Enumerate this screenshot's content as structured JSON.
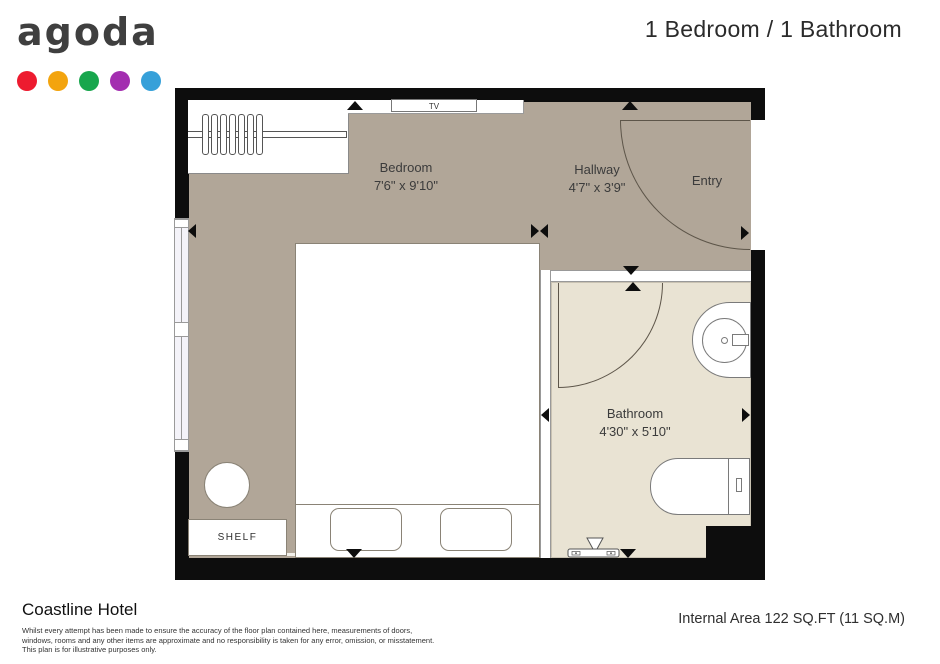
{
  "logo": {
    "text": "agoda",
    "dot_colors": [
      "#ed1b2f",
      "#f3a40e",
      "#18a64d",
      "#a32eb0",
      "#36a0d9"
    ]
  },
  "header": {
    "title": "1 Bedroom / 1 Bathroom"
  },
  "plan": {
    "rooms": {
      "bedroom": {
        "name": "Bedroom",
        "dims": "7'6\" x 9'10\""
      },
      "hallway": {
        "name": "Hallway",
        "dims": "4'7\" x 3'9\""
      },
      "entry": {
        "name": "Entry"
      },
      "bathroom": {
        "name": "Bathroom",
        "dims": "4'30\" x 5'10\""
      }
    },
    "fixtures": {
      "tv": "TV",
      "shelf": "SHELF"
    },
    "colors": {
      "wall": "#0d0d0d",
      "floor": "#b1a698",
      "bathroom_floor": "#e9e3d3"
    }
  },
  "footer": {
    "hotel_name": "Coastline Hotel",
    "disclaimer": [
      "Whilst every attempt has been made to ensure the accuracy of the floor plan contained here, measurements of doors,",
      "windows, rooms and any other items are approximate and no responsibility is taken for any error, omission, or misstatement.",
      "This plan is for illustrative purposes only."
    ],
    "internal_area": "Internal Area 122 SQ.FT (11 SQ.M)"
  }
}
